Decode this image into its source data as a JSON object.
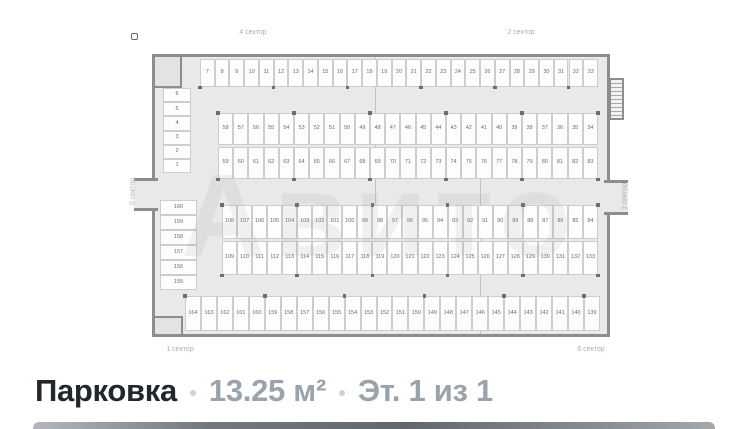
{
  "watermark_text": "Авито",
  "caption": {
    "title": "Парковка",
    "area": "13.25 м²",
    "floor": "Эт. 1 из 1"
  },
  "colors": {
    "title": "#21272e",
    "meta": "#99a3ad",
    "dot": "#cbd2d8",
    "wall": "#8d8d8d",
    "floor": "#e9e9e9",
    "cell_number": "#6b6b6b"
  },
  "plan": {
    "sector_labels": {
      "top_left": "4 сектор",
      "top_right": "2 сектор",
      "bottom_left": "1 сектор",
      "bottom_right": "6 сектор",
      "left": "5 сектор",
      "right": "3 сектор"
    },
    "spaces": {
      "left_upper_stack": [
        "6",
        "5",
        "4",
        "3",
        "2",
        "1"
      ],
      "top_row": [
        "7",
        "8",
        "9",
        "10",
        "11",
        "12",
        "13",
        "14",
        "15",
        "16",
        "17",
        "18",
        "19",
        "20",
        "21",
        "22",
        "23",
        "24",
        "25",
        "26",
        "27",
        "28",
        "29",
        "30",
        "31",
        "32",
        "33"
      ],
      "row_a": [
        "58",
        "57",
        "56",
        "55",
        "54",
        "53",
        "52",
        "51",
        "50",
        "49",
        "48",
        "47",
        "46",
        "45",
        "44",
        "43",
        "42",
        "41",
        "40",
        "39",
        "38",
        "37",
        "36",
        "35",
        "34"
      ],
      "row_b": [
        "59",
        "60",
        "61",
        "62",
        "63",
        "64",
        "65",
        "66",
        "67",
        "68",
        "69",
        "70",
        "71",
        "72",
        "73",
        "74",
        "75",
        "76",
        "77",
        "78",
        "79",
        "80",
        "81",
        "82",
        "83"
      ],
      "left_lower_stack": [
        "160",
        "159",
        "158",
        "157",
        "156",
        "155"
      ],
      "row_c": [
        "108",
        "107",
        "106",
        "105",
        "104",
        "103",
        "102",
        "101",
        "100",
        "99",
        "98",
        "97",
        "96",
        "95",
        "94",
        "93",
        "92",
        "91",
        "90",
        "89",
        "88",
        "87",
        "86",
        "85",
        "84"
      ],
      "row_d": [
        "109",
        "110",
        "111",
        "112",
        "113",
        "114",
        "115",
        "116",
        "117",
        "118",
        "119",
        "120",
        "121",
        "122",
        "123",
        "124",
        "125",
        "126",
        "127",
        "128",
        "129",
        "130",
        "131",
        "132",
        "133"
      ],
      "bottom_row": [
        "164",
        "163",
        "162",
        "161",
        "160",
        "159",
        "158",
        "157",
        "156",
        "155",
        "154",
        "153",
        "152",
        "151",
        "150",
        "149",
        "148",
        "147",
        "146",
        "145",
        "144",
        "143",
        "142",
        "141",
        "140",
        "139"
      ]
    }
  }
}
